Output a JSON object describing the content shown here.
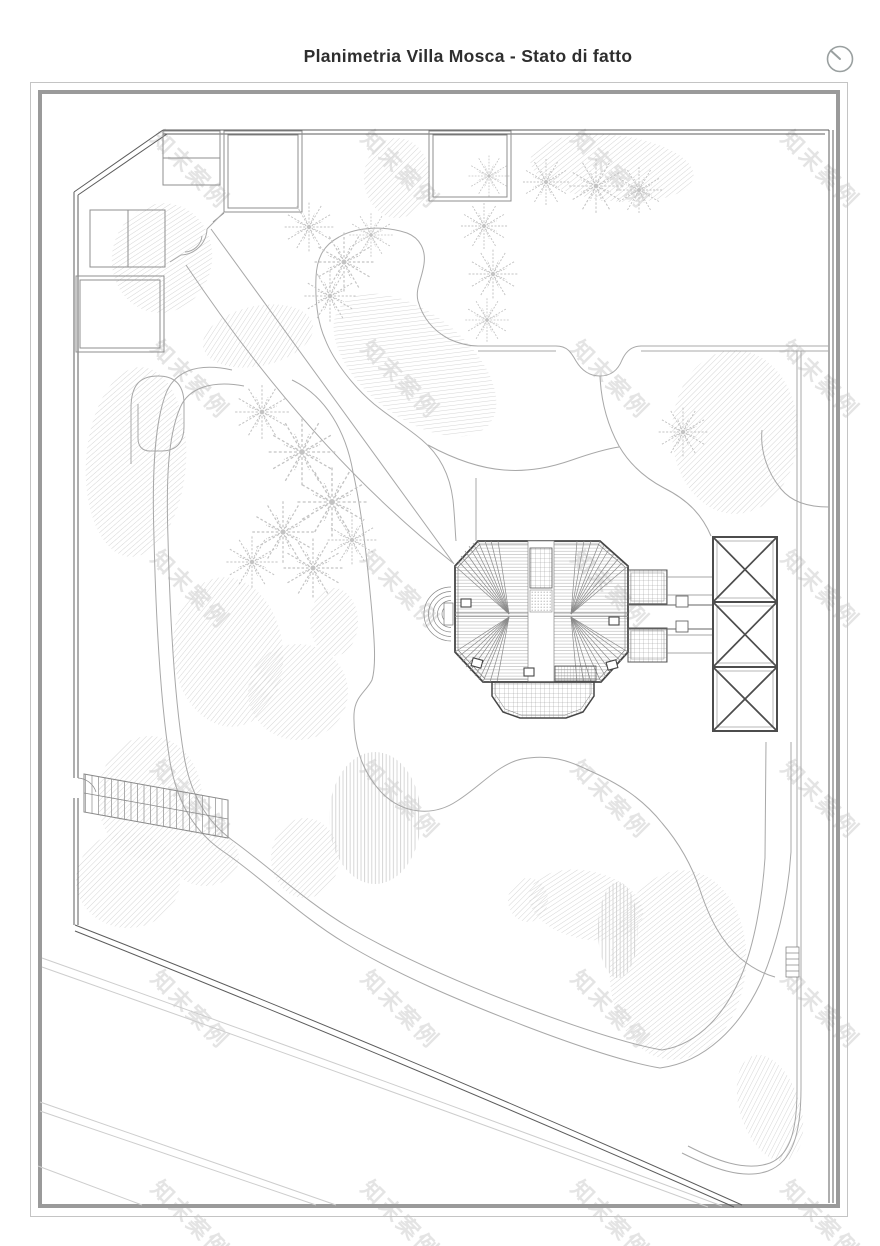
{
  "header": {
    "title": "Planimetria Villa Mosca - Stato di fatto"
  },
  "watermark": {
    "text": "知末案例"
  },
  "icons": {
    "top_right": "clock-icon"
  },
  "colors": {
    "frame-outer": "#c4c4c4",
    "frame-inner": "#9a9a9a",
    "boundary": "#5c5c5c",
    "building": "#464646",
    "path": "#a8a8a8",
    "road": "#cdcdcd",
    "hatch": "#d6d6d6",
    "tree": "#c3c3c3",
    "title": "#2e2e2e",
    "icon": "#9aa0a0",
    "wm": "#dcdcdc"
  }
}
